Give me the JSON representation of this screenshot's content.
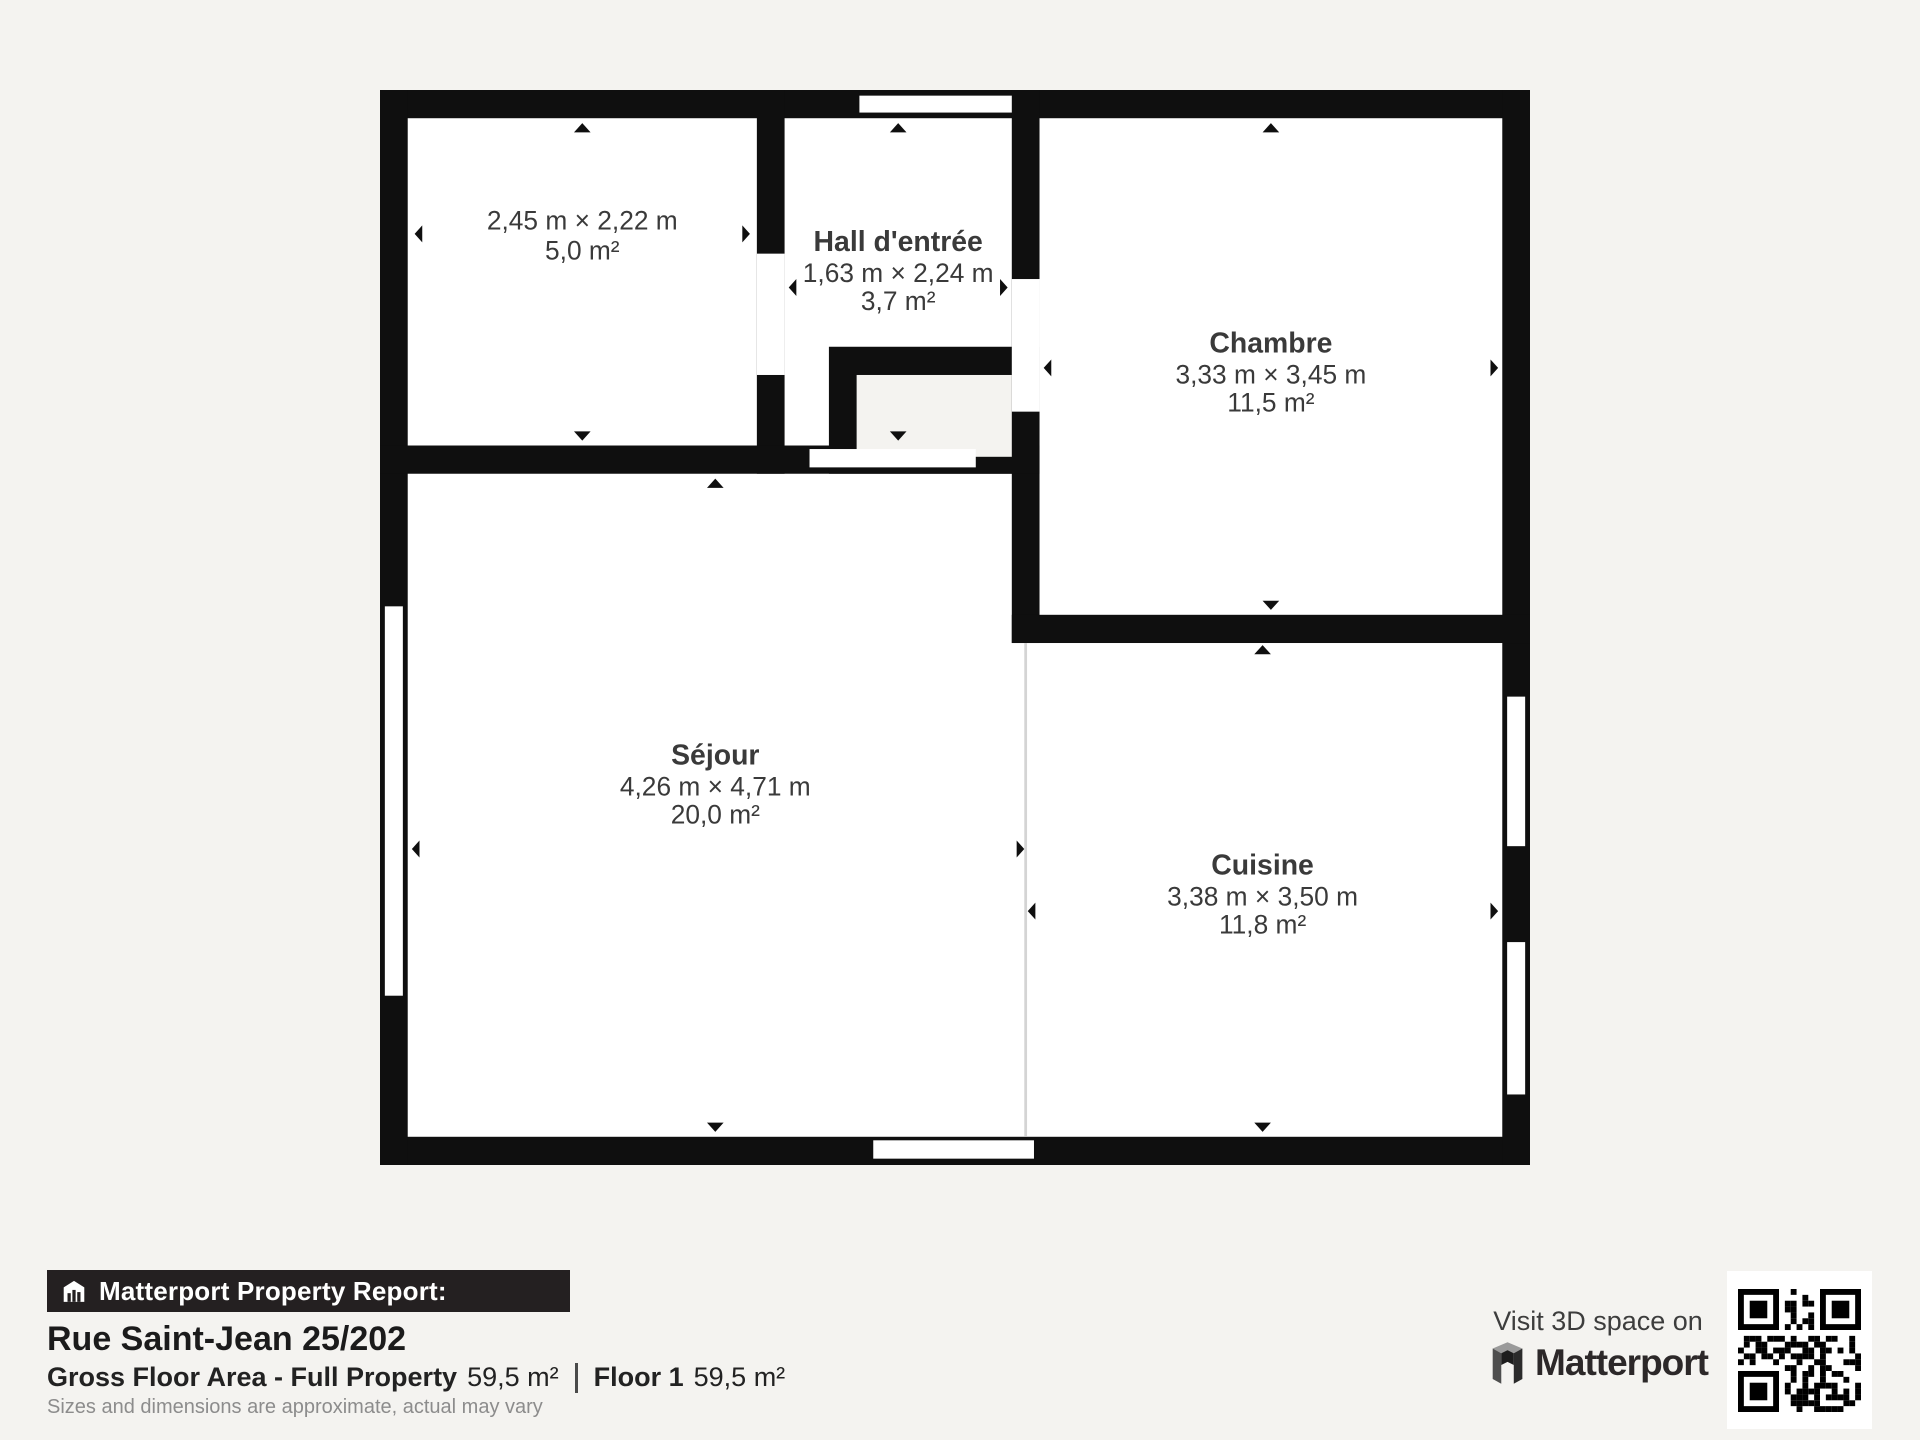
{
  "plan": {
    "wall_color": "#0f0f0f",
    "floor_color": "#ffffff",
    "background_color": "#f4f3f0",
    "rooms": [
      {
        "name": "",
        "dims": "2,45 m × 2,22 m",
        "area": "5,0 m²"
      },
      {
        "name": "Hall d'entrée",
        "dims": "1,63 m × 2,24 m",
        "area": "3,7 m²"
      },
      {
        "name": "Chambre",
        "dims": "3,33 m × 3,45 m",
        "area": "11,5 m²"
      },
      {
        "name": "Séjour",
        "dims": "4,26 m × 4,71 m",
        "area": "20,0 m²"
      },
      {
        "name": "Cuisine",
        "dims": "3,38 m × 3,50 m",
        "area": "11,8 m²"
      }
    ]
  },
  "footer": {
    "banner": "Matterport Property Report:",
    "address": "Rue Saint-Jean 25/202",
    "gfa_label": "Gross Floor Area - Full Property",
    "gfa_value": "59,5 m²",
    "floor_label": "Floor 1",
    "floor_value": "59,5 m²",
    "disclaimer": "Sizes and dimensions are approximate, actual may vary"
  },
  "cta": {
    "line1": "Visit 3D space on",
    "brand": "Matterport"
  }
}
